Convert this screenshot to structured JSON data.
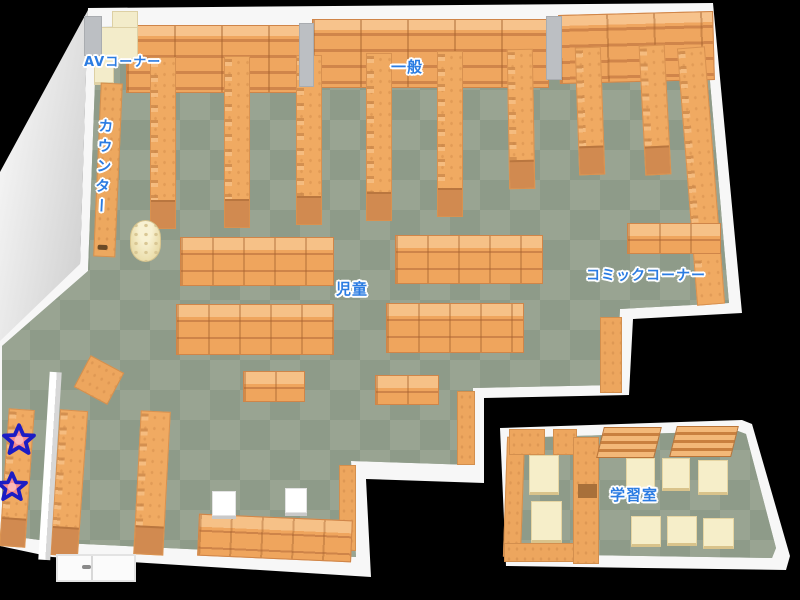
{
  "floor_map": {
    "areas": [
      {
        "id": "av-corner",
        "label": "AVコーナー"
      },
      {
        "id": "counter",
        "label": "カウンター"
      },
      {
        "id": "general",
        "label": "一般"
      },
      {
        "id": "children",
        "label": "児童"
      },
      {
        "id": "comic-corner",
        "label": "コミックコーナー"
      },
      {
        "id": "study-room",
        "label": "学習室"
      }
    ],
    "markers": [
      {
        "id": "star-1",
        "type": "star-marker"
      },
      {
        "id": "star-2",
        "type": "star-marker"
      }
    ],
    "colors": {
      "background": "#000000",
      "floor_light": "#99a492",
      "floor_dark": "#8e9b89",
      "shelf_orange": "#f0a65e",
      "shelf_front": "#d0854a",
      "wall_white": "#f7f7f7",
      "cream": "#f3ecca",
      "label_blue": "#2b7ce2",
      "star_fill": "#f58c8c",
      "star_outline": "#1c1cc4"
    }
  }
}
